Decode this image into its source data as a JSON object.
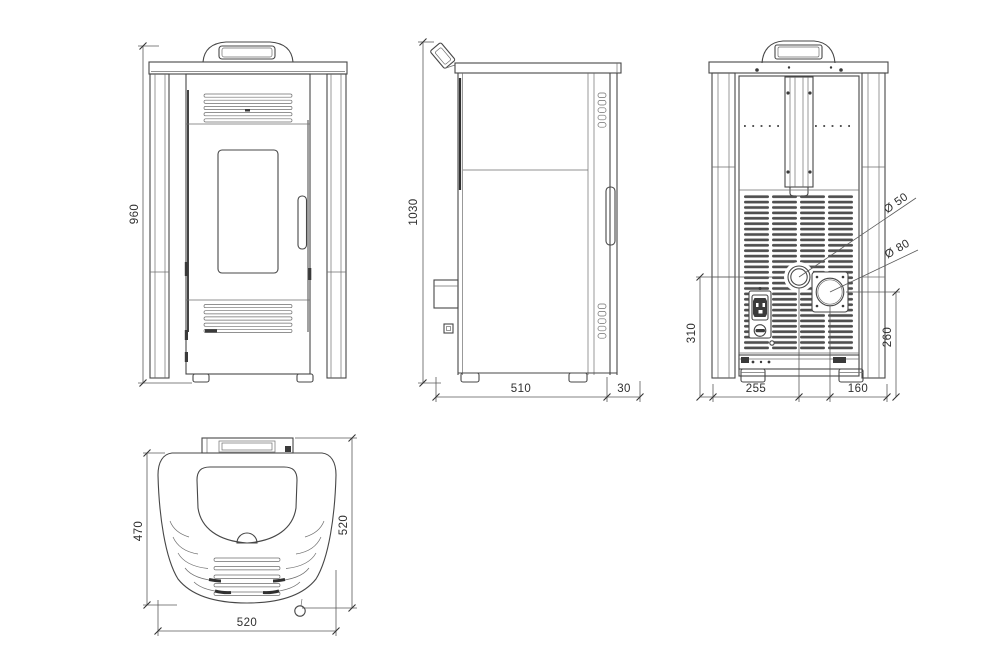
{
  "colors": {
    "background": "#ffffff",
    "line": "#474747",
    "dimension_line": "#5a5a5a",
    "text": "#2f2f2f"
  },
  "views": {
    "front": {
      "dims": {
        "height": "960"
      }
    },
    "side": {
      "dims": {
        "height": "1030",
        "depth": "510",
        "handle_offset": "30"
      }
    },
    "rear": {
      "dims": {
        "intake_height": "310",
        "intake_offset": "255",
        "flue_height": "260",
        "flue_offset": "160",
        "intake_diameter": "Ø 50",
        "flue_diameter": "Ø 80"
      }
    },
    "top": {
      "dims": {
        "body_depth": "470",
        "total_depth": "520",
        "width": "520"
      }
    }
  }
}
